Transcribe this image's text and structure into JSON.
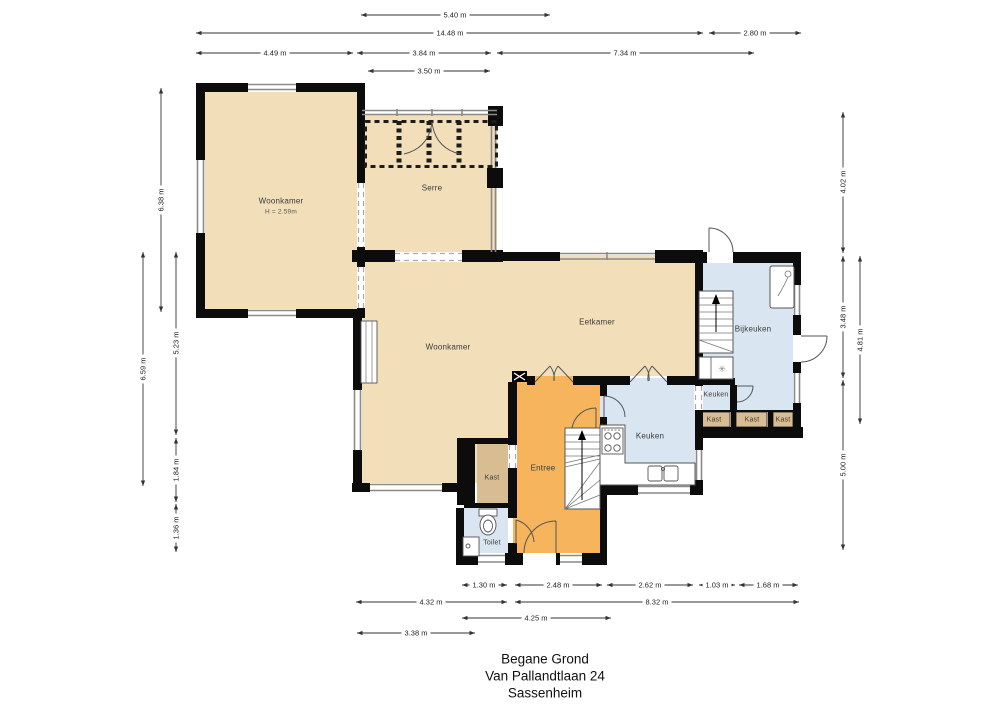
{
  "title": {
    "lines": [
      "Begane Grond",
      "Van Pallandtlaan 24",
      "Sassenheim"
    ]
  },
  "rooms": {
    "woonkamer_boven": {
      "label": "Woonkamer",
      "height_note": "H = 2.59m"
    },
    "serre": {
      "label": "Serre"
    },
    "woonkamer": {
      "label": "Woonkamer"
    },
    "eetkamer": {
      "label": "Eetkamer"
    },
    "bijkeuken": {
      "label": "Bijkeuken"
    },
    "keuken_hoek": {
      "label": "Keuken"
    },
    "keuken": {
      "label": "Keuken"
    },
    "kast_1": {
      "label": "Kast"
    },
    "kast_2": {
      "label": "Kast"
    },
    "kast_3": {
      "label": "Kast"
    },
    "kast_hal": {
      "label": "Kast"
    },
    "entree": {
      "label": "Entree"
    },
    "toilet": {
      "label": "Toilet"
    }
  },
  "dimensions": {
    "top": [
      "5.40 m",
      "14.48 m",
      "2.80 m",
      "4.49 m",
      "3.84 m",
      "7.34 m",
      "3.50 m"
    ],
    "left": [
      "6.38 m",
      "6.59 m",
      "5.23 m",
      "1.84 m",
      "1.36 m"
    ],
    "right": [
      "4.02 m",
      "3.48 m",
      "4.81 m",
      "5.00 m"
    ],
    "bottom": [
      "1.30 m",
      "2.48 m",
      "2.62 m",
      "1.03 m",
      "1.68 m",
      "4.32 m",
      "8.32 m",
      "4.25 m",
      "3.38 m"
    ]
  },
  "icons": {
    "washer_glyph": "✳"
  },
  "colors": {
    "room_beige": "#f2dfba",
    "room_orange": "#f6b55d",
    "room_blue": "#d9e6f2",
    "closet_tan": "#d8bd92",
    "wall_black": "#0c0c0c",
    "window_gray": "#8a8a8a"
  }
}
